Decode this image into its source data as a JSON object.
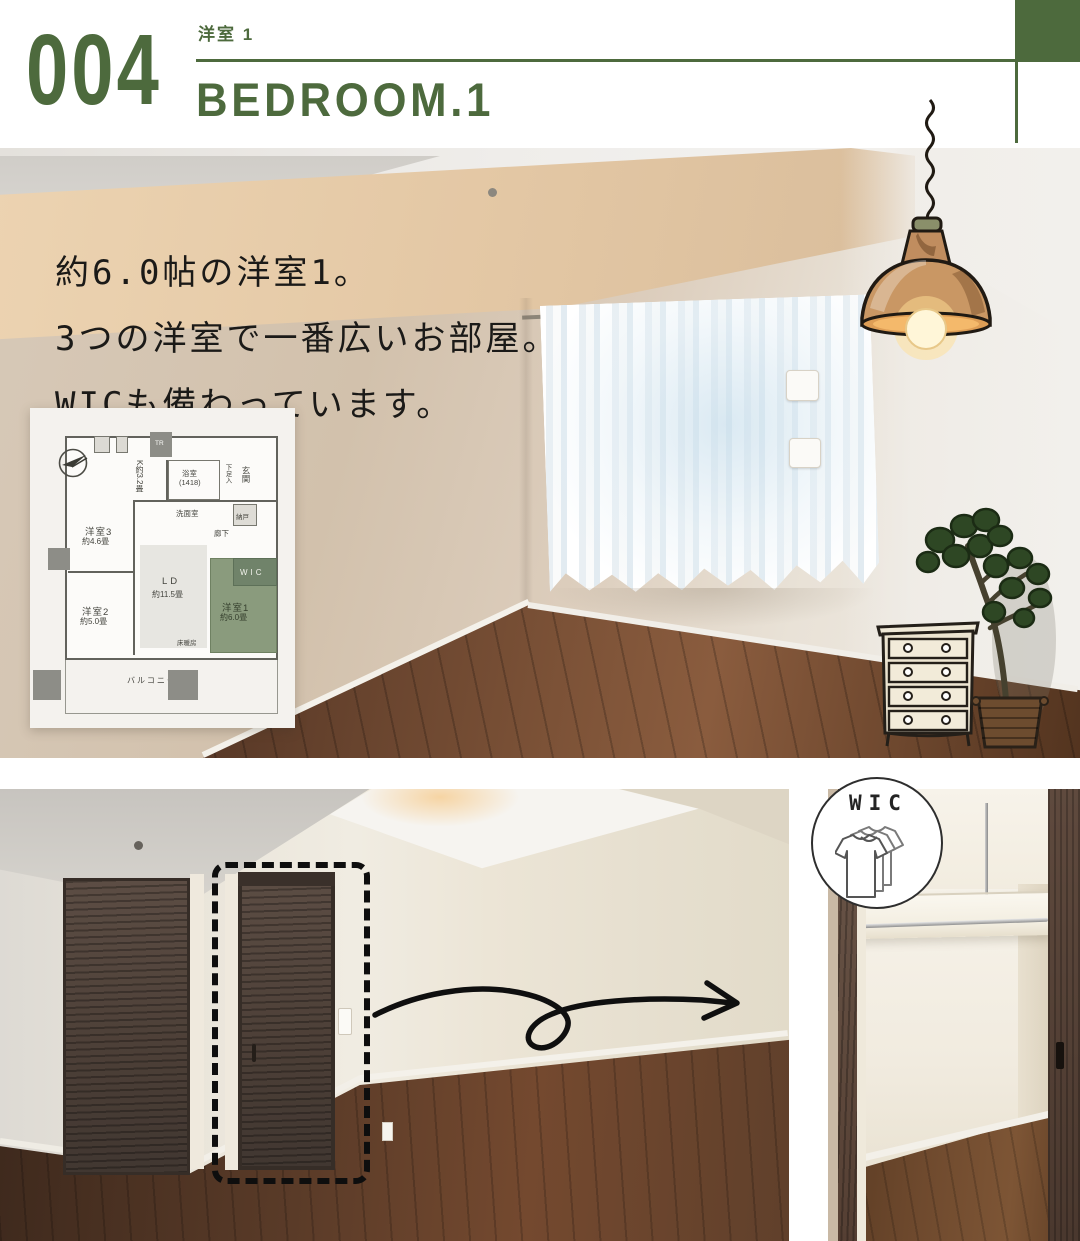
{
  "colors": {
    "accent_green": "#4d6a3d",
    "floorplan_room_green": "#8a9b7d",
    "floorplan_wic_green": "#70836a"
  },
  "header": {
    "number": "004",
    "subtitle": "洋室 1",
    "title": "BEDROOM.1"
  },
  "main_photo": {
    "description_lines": [
      "約6.0帖の洋室1。",
      "3つの洋室で一番広いお部屋。",
      "WICも備わっています。"
    ]
  },
  "floorplan": {
    "labels": {
      "tr": "TR",
      "kitchen": "K約3.2畳",
      "bath_name": "浴室",
      "bath_size": "(1418)",
      "shoe_box": "下足入",
      "entrance": "玄関",
      "washroom": "洗面室",
      "storage": "納戸",
      "hallway": "廊下",
      "bedroom3_name": "洋室3",
      "bedroom3_size": "約4.6畳",
      "bedroom2_name": "洋室2",
      "bedroom2_size": "約5.0畳",
      "bedroom1_name": "洋室1",
      "bedroom1_size": "約6.0畳",
      "living_name": "LD",
      "living_size": "約11.5畳",
      "floor_heating": "床暖房",
      "wic": "WIC",
      "balcony": "バルコニー"
    }
  },
  "wic_badge": {
    "label": "WIC"
  }
}
